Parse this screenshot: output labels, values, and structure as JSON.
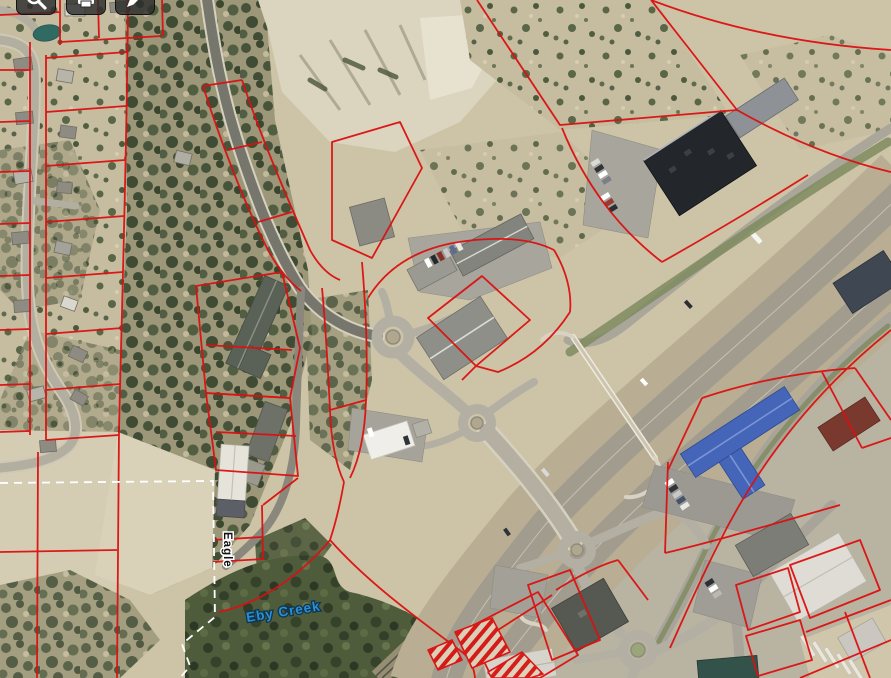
{
  "labels": {
    "street": "Eagle",
    "creek": "Eby Creek"
  },
  "toolbar": {
    "buttons": [
      {
        "name": "search",
        "icon": "search-icon"
      },
      {
        "name": "print",
        "icon": "print-icon"
      },
      {
        "name": "draw",
        "icon": "pencil-icon"
      }
    ]
  },
  "colors": {
    "parcel_line": "#dc1010",
    "municipal_boundary_dash": "#ffffff",
    "creek_label_fill": "#2d8ecf",
    "street_label_fill": "#111111",
    "toolbar_button_bg": "rgba(45,45,45,0.82)",
    "highway_pavement": "#a29c8e",
    "terrain_base": "#cdc4a8"
  }
}
